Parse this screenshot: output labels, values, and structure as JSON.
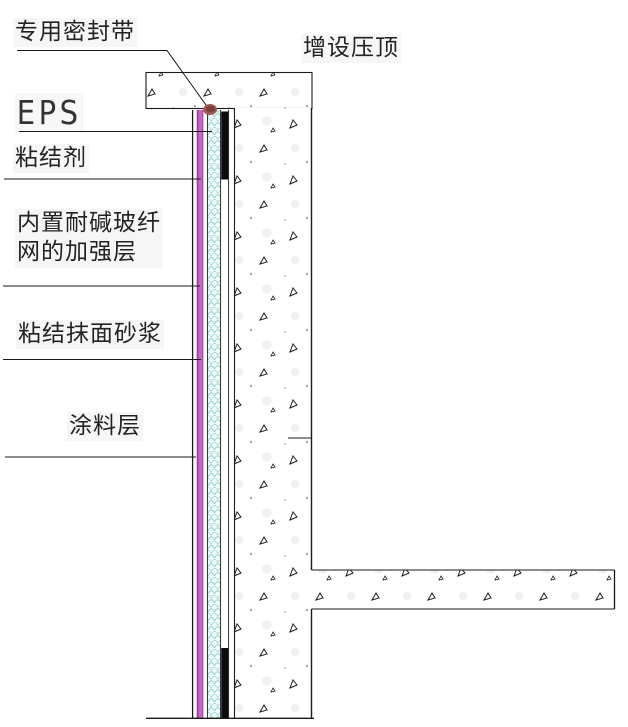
{
  "diagram": {
    "type": "construction-detail-section",
    "callouts": {
      "sealing_tape": "专用密封带",
      "coping": "增设压顶",
      "eps": "EPS",
      "adhesive": "粘结剂",
      "mesh_layer_line1": "内置耐碱玻纤",
      "mesh_layer_line2": "网的加强层",
      "mortar": "粘结抹面砂浆",
      "coating": "涂料层"
    },
    "colors": {
      "line": "#1a1a1a",
      "text": "#222222",
      "mortar_layer": "#c468c4",
      "mortar_layer_edge": "#993d99",
      "eps_hatch": "#8fcfcf",
      "eps_bg": "#f3fbfb",
      "adhesive_layer": "#0c0c12",
      "sealing_tape": "#a25a52",
      "sealing_tape_core": "#7f3f3a",
      "concrete_bg": "#ffffff"
    }
  }
}
